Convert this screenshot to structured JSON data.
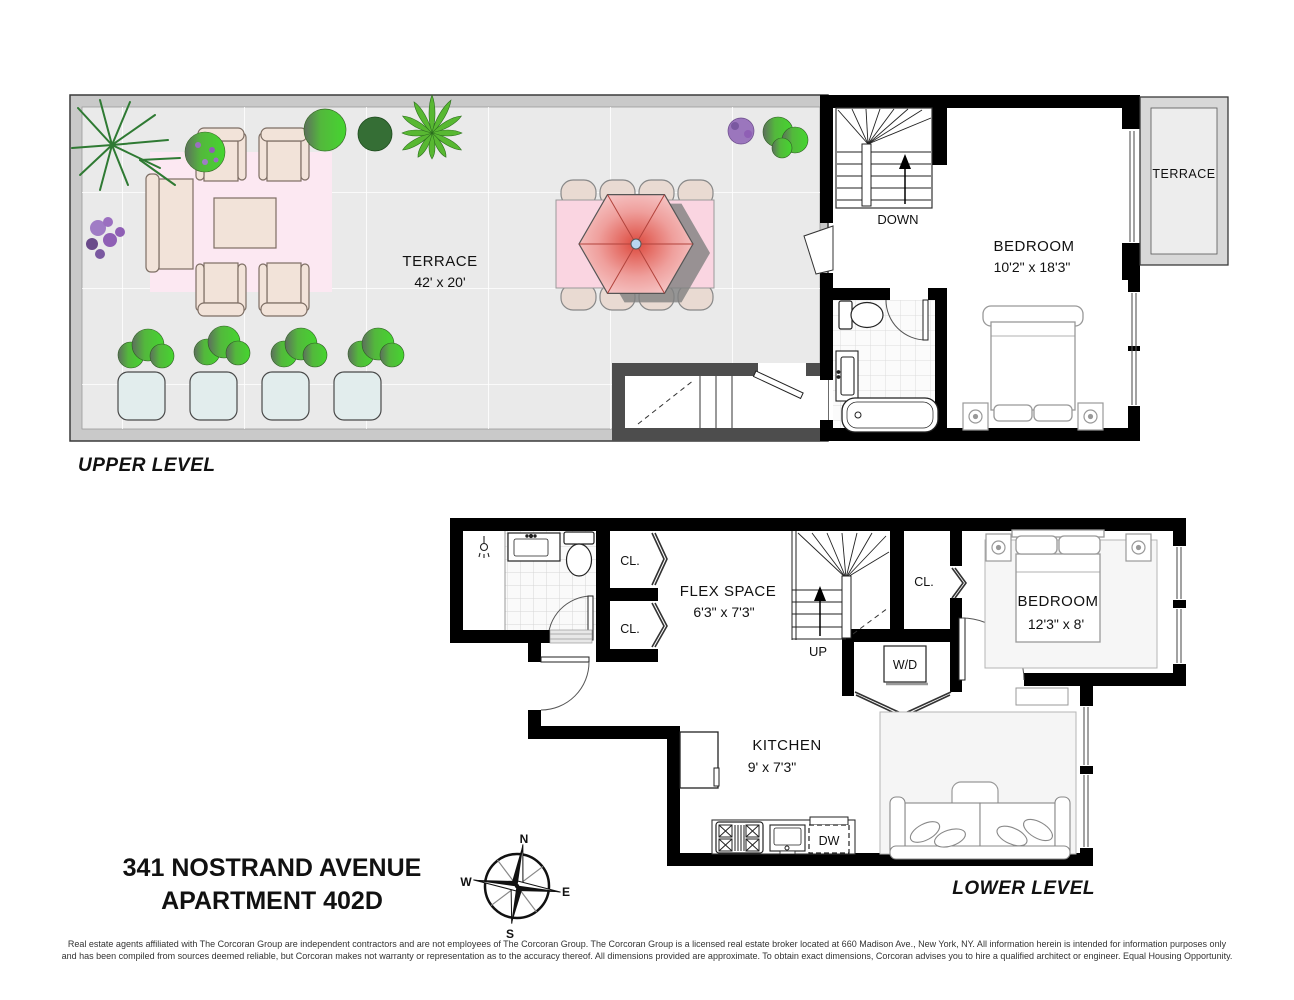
{
  "upper_level": {
    "title": "UPPER LEVEL",
    "main_terrace": {
      "name": "TERRACE",
      "dims": "42' x 20'"
    },
    "bedroom": {
      "name": "BEDROOM",
      "dims": "10'2\" x 18'3\""
    },
    "stair_label": "DOWN",
    "side_terrace": {
      "name": "TERRACE"
    }
  },
  "lower_level": {
    "title": "LOWER LEVEL",
    "flex_space": {
      "name": "FLEX SPACE",
      "dims": "6'3\" x 7'3\""
    },
    "kitchen": {
      "name": "KITCHEN",
      "dims": "9' x 7'3\""
    },
    "bedroom": {
      "name": "BEDROOM",
      "dims": "12'3\" x 8'"
    },
    "stair_label": "UP",
    "closet_label_1": "CL.",
    "closet_label_2": "CL.",
    "closet_label_3": "CL.",
    "washer_dryer_label": "W/D",
    "dishwasher_label": "DW"
  },
  "footer": {
    "address_line_1": "341 NOSTRAND AVENUE",
    "address_line_2": "APARTMENT 402D",
    "disclaimer_line_1": "Real estate agents affiliated with The Corcoran Group are independent contractors and are not employees of The Corcoran Group. The Corcoran Group is a licensed real estate broker located at 660 Madison Ave., New York, NY. All information herein is intended for information purposes only",
    "disclaimer_line_2": "and has been compiled from sources deemed reliable, but Corcoran makes not warranty or representation as to the accuracy thereof. All dimensions provided are approximate. To obtain exact dimensions, Corcoran advises you to hire a qualified architect or engineer. Equal Housing Opportunity."
  },
  "compass": {
    "north": "N",
    "south": "S",
    "east": "E",
    "west": "W"
  },
  "colors": {
    "wall": "#000000",
    "terrace_band": "#c9c9c9",
    "terrace_floor": "#eaeaea",
    "bulkhead_wall": "#4d4d4d",
    "area_rug_pink": "#fce8f2",
    "dining_table_pink": "#fad5e1",
    "umbrella_red": "#dd4a3e",
    "planter_teal": "#e2eded",
    "side_terrace_floor": "#ededed"
  }
}
